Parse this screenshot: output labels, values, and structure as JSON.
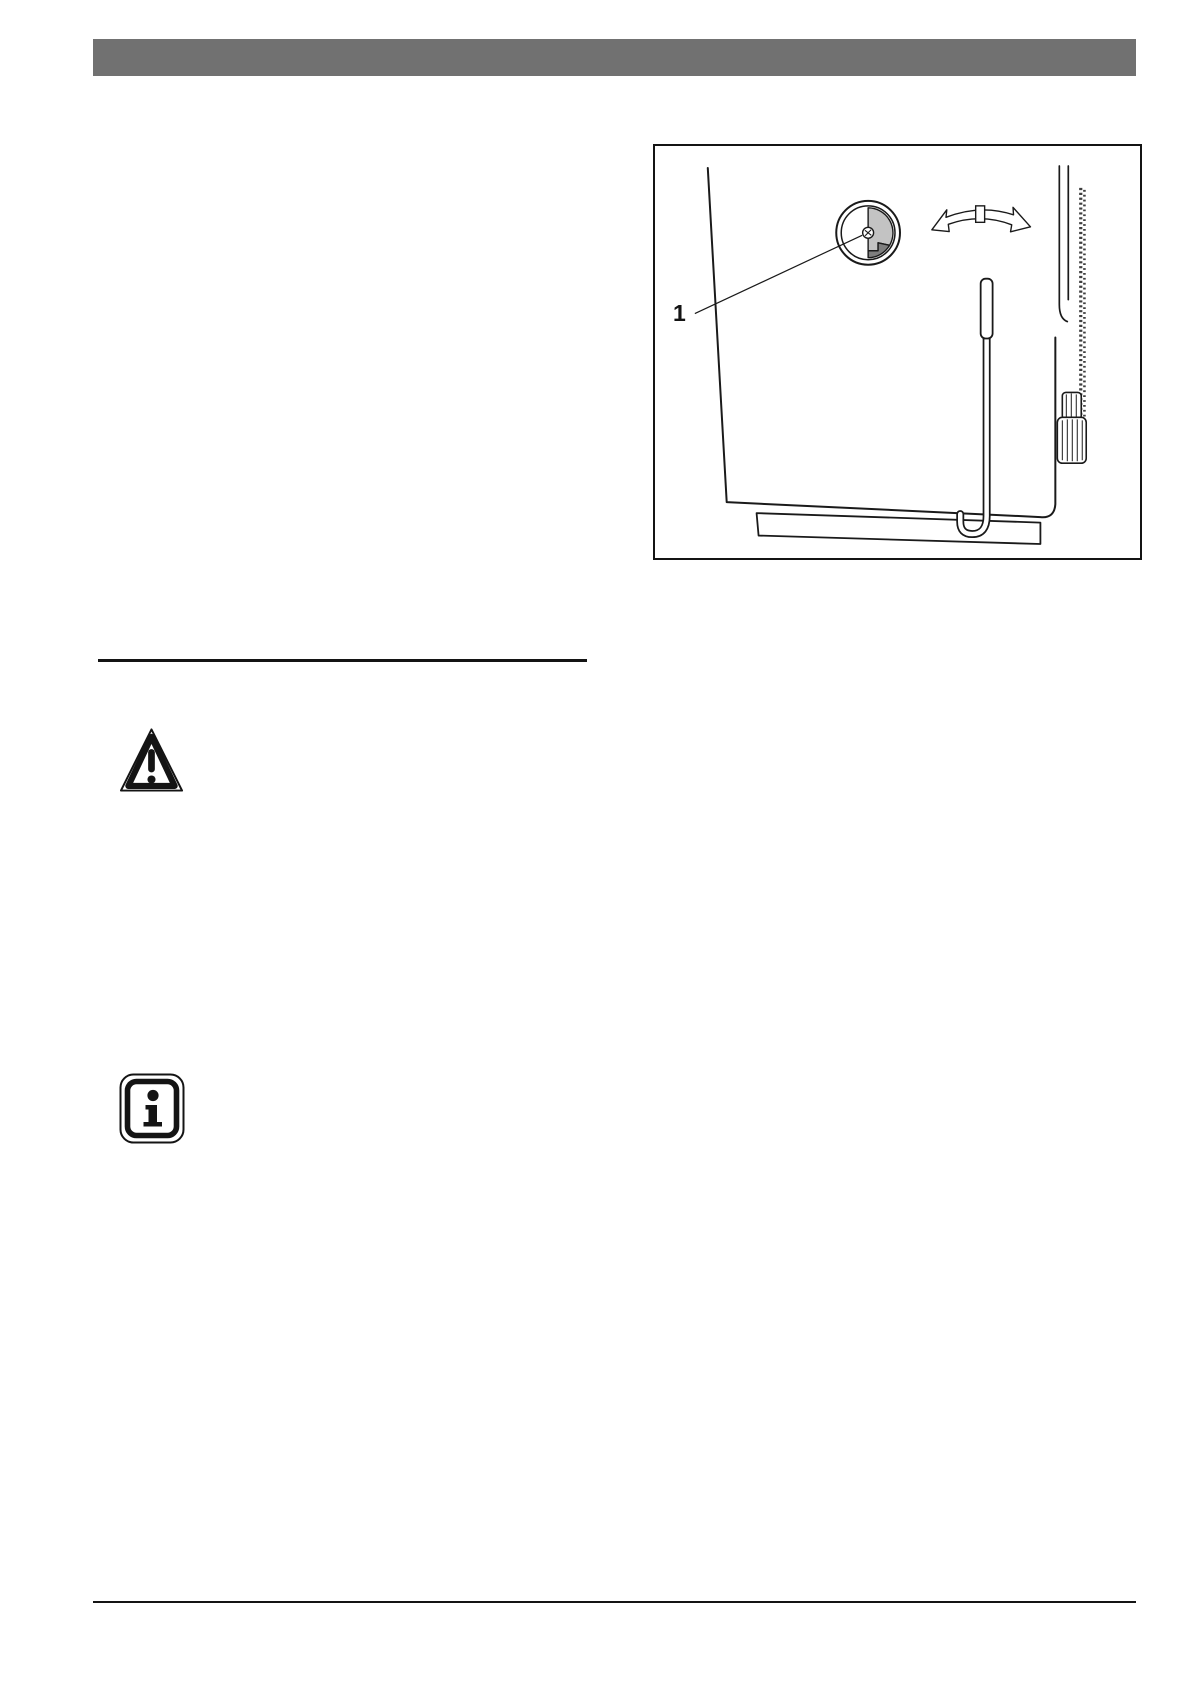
{
  "page": {
    "background": "#ffffff",
    "header_bar_color": "#717171",
    "rule_color": "#141414"
  },
  "figure": {
    "callout_label": "1",
    "line_color": "#1a1a1a",
    "dial_light_gray": "#c3c3c3",
    "dial_dark_gray": "#7e7e7e"
  },
  "icons": {
    "warning_icon_name": "warning-triangle-icon",
    "info_icon_name": "info-icon"
  }
}
